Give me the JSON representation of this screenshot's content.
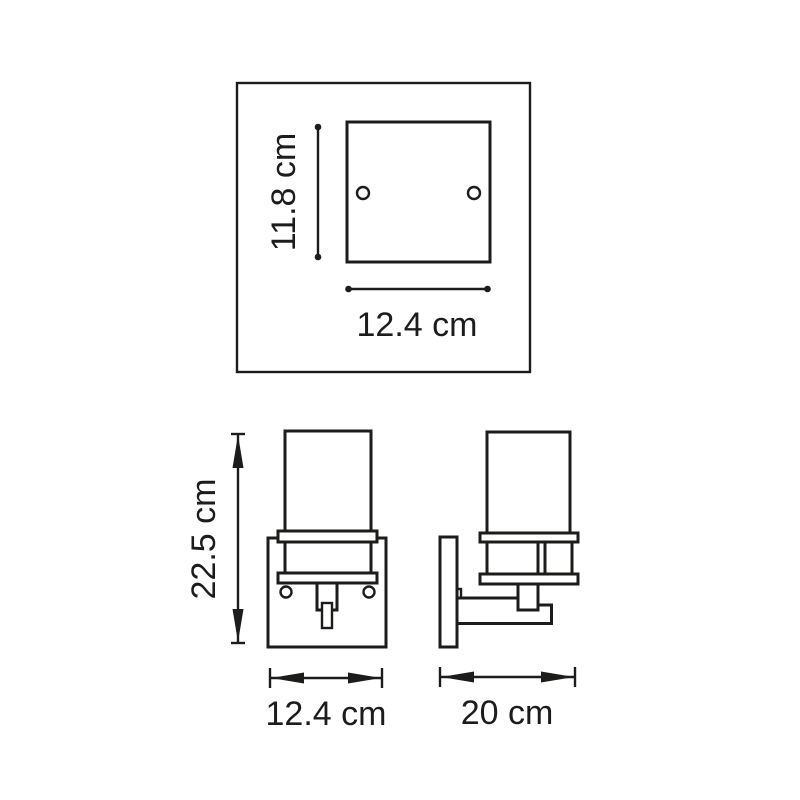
{
  "diagram": {
    "line_color": "#1c1c1b",
    "background_color": "#ffffff",
    "top_view": {
      "height_label": "11.8 cm",
      "width_label": "12.4 cm"
    },
    "front_view": {
      "height_label": "22.5 cm",
      "width_label": "12.4 cm"
    },
    "side_view": {
      "depth_label": "20 cm"
    }
  }
}
